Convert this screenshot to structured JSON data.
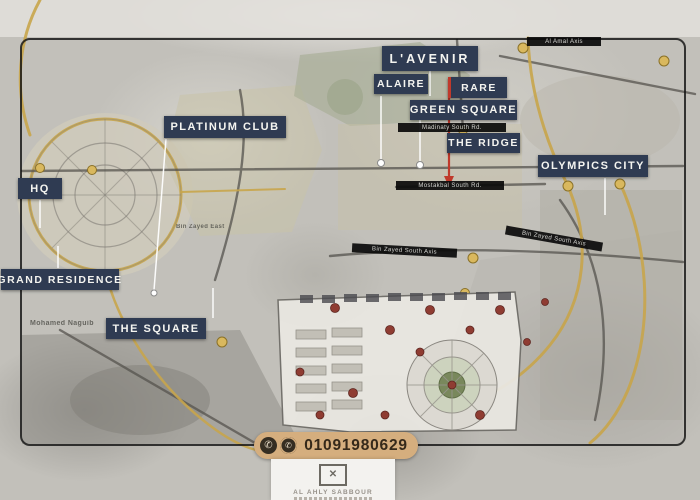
{
  "labels": {
    "lavenir": "L'AVENIR",
    "alaire": "ALAIRE",
    "rare": "RARE",
    "green_square": "GREEN SQUARE",
    "the_ridge": "THE RIDGE",
    "olympics_city": "OLYMPICS CITY",
    "platinum_club": "PLATINUM CLUB",
    "hq": "HQ",
    "grand_residence": "GRAND RESIDENCE",
    "the_square": "THE SQUARE"
  },
  "roads": {
    "al_amal_axis": "Al Amal Axis",
    "madinaty_south_rd": "Madinaty South Rd.",
    "mostakbal_south_rd": "Mostakbal South Rd.",
    "bin_zayed_south_axis_left": "Bin Zayed South Axis",
    "bin_zayed_south_axis_right": "Bin Zayed South Axis",
    "bin_zayed_east": "Bin Zayed East",
    "mohamed_naguib": "Mohamed Naguib"
  },
  "contact": {
    "phone_number": "01091980629",
    "phone_icon": "phone-icon",
    "whatsapp_icon": "whatsapp-icon"
  },
  "brand": {
    "company": "AL AHLY SABBOUR"
  },
  "colors": {
    "label_bg": "#2f3b52",
    "road_strip_bg": "#0a0a0a",
    "accent_red": "#c0392b",
    "road_gold": "#c8a54b",
    "phone_pill_bg": "#d5ae7e",
    "map_base": "#c2c0ba"
  }
}
